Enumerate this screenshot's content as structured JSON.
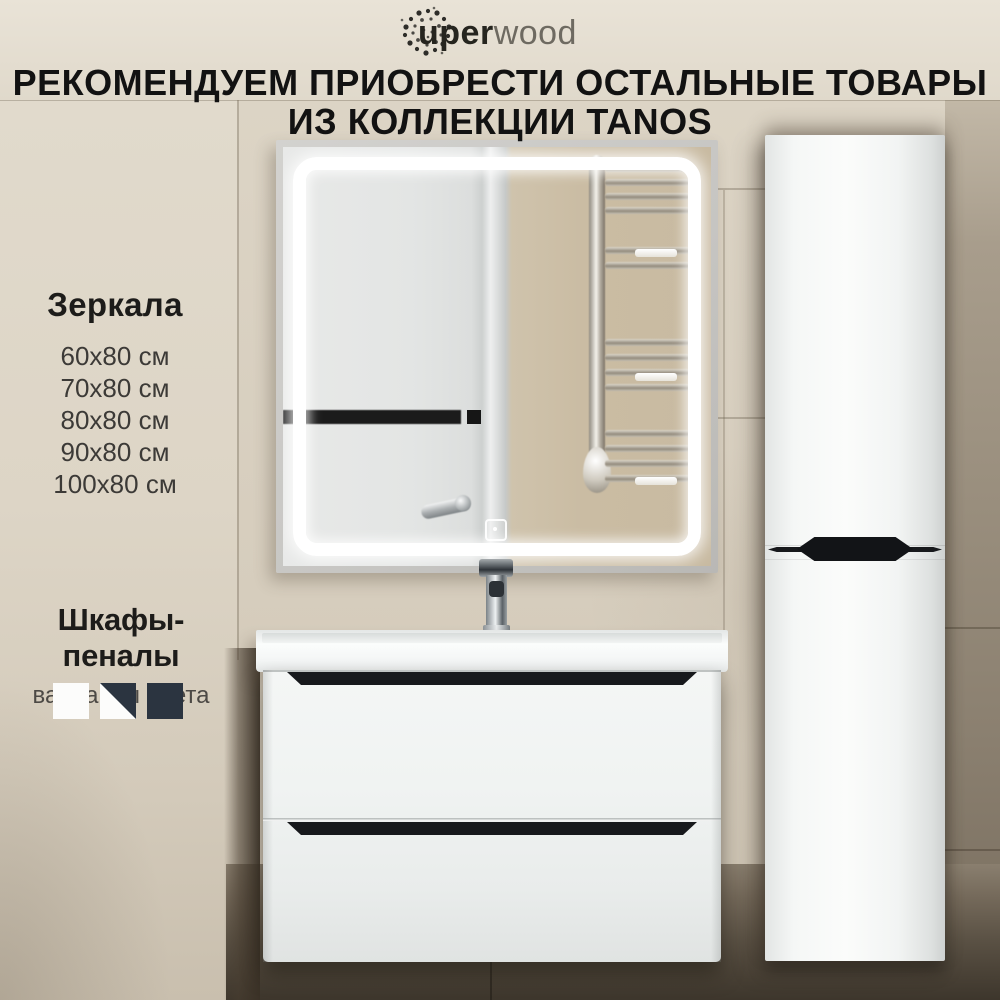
{
  "brand": {
    "logo_text_bold": "uper",
    "logo_text_light": "wood"
  },
  "heading": {
    "line1": "РЕКОМЕНДУЕМ ПРИОБРЕСТИ ОСТАЛЬНЫЕ ТОВАРЫ",
    "line2": "ИЗ КОЛЛЕКЦИИ TANOS"
  },
  "mirrors": {
    "title": "Зеркала",
    "sizes": [
      "60x80 см",
      "70x80 см",
      "80x80 см",
      "90x80 см",
      "100x80 см"
    ]
  },
  "cabinets": {
    "title": "Шкафы-пеналы",
    "subtitle": "варианты цвета",
    "color_options": [
      {
        "name": "white",
        "hex": "#fcfcfb"
      },
      {
        "name": "white-graphite-split",
        "hex_top": "#2b3440",
        "hex_bottom": "#fcfcfb"
      },
      {
        "name": "graphite",
        "hex": "#2b3440"
      }
    ]
  },
  "palette": {
    "wall_beige": "#d8cfc0",
    "wall_shadow_dark": "#473f34",
    "furniture_white": "#f5f7f6",
    "handle_black": "#17191c",
    "led_white": "#ffffff"
  }
}
